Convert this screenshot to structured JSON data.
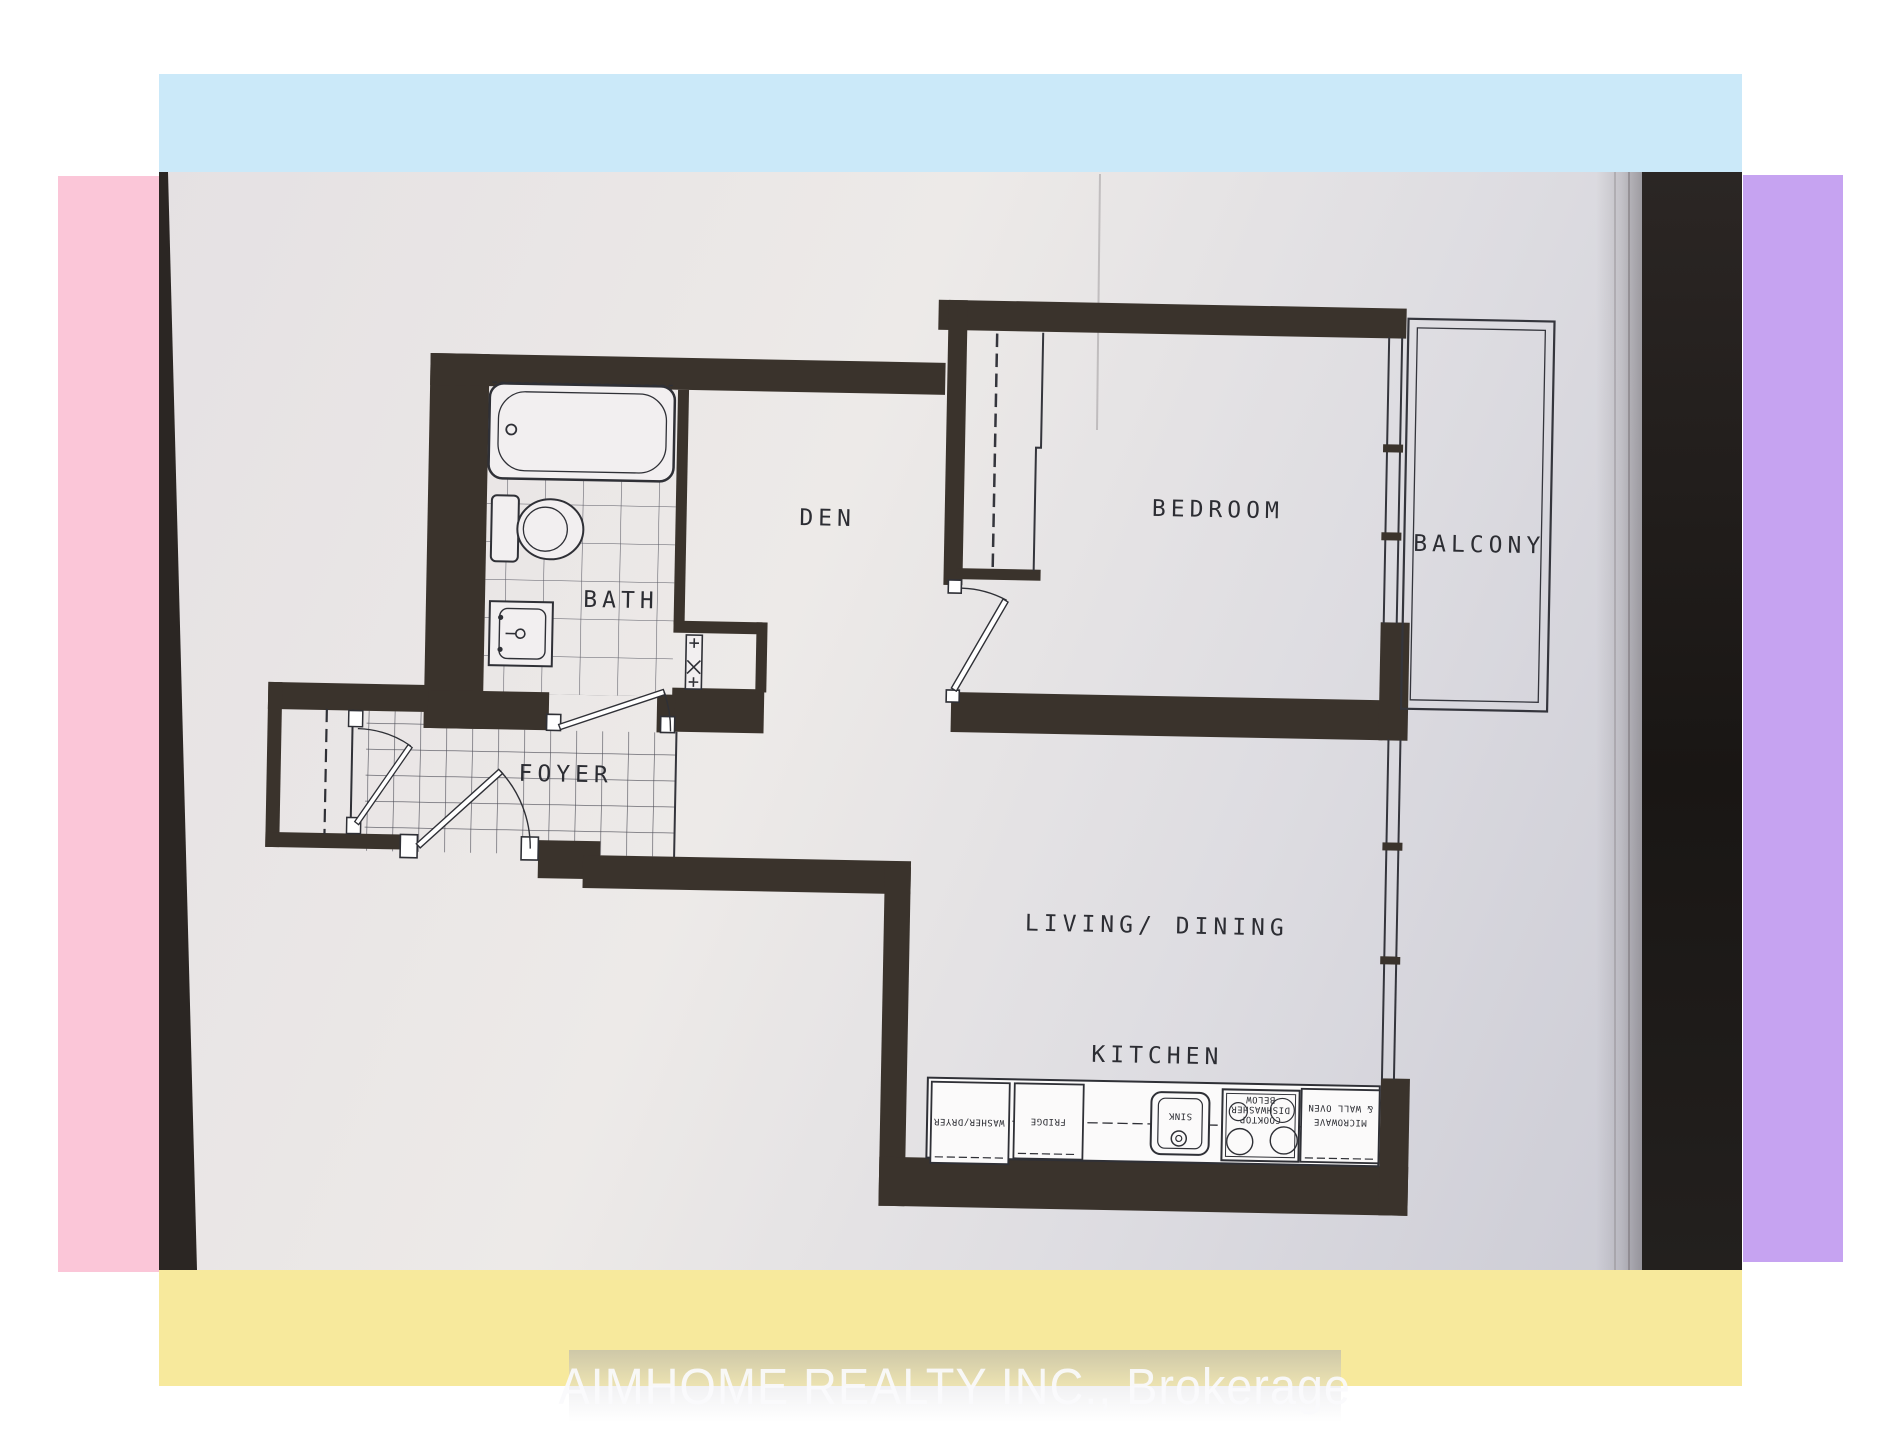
{
  "colors": {
    "canvas": "#ffffff",
    "cyan": "#cbe9f9",
    "pink": "#fbc6d8",
    "purple": "#c6a3f1",
    "yellow": "#f7e99c",
    "paper-light": "#edeae8",
    "paper-dark": "#c9c9d3",
    "table": "#211d1a",
    "wall": "#3a332c",
    "line": "#34353c",
    "label": "#2c2d33"
  },
  "rooms": {
    "den": "DEN",
    "bath": "BATH",
    "foyer": "FOYER",
    "bedroom": "BEDROOM",
    "balcony": "BALCONY",
    "living_dining": "LIVING/ DINING",
    "kitchen": "KITCHEN"
  },
  "appliances": {
    "washer_dryer": "WASHER/DRYER",
    "fridge": "FRIDGE",
    "sink": "SINK",
    "cooktop_line1": "COOKTOP",
    "cooktop_line2": "DISHWASHER",
    "cooktop_line3": "BELOW",
    "microwave_line1": "MICROWAVE",
    "microwave_line2": "& WALL OVEN"
  },
  "watermark": {
    "text": "AIMHOME REALTY INC., Brokerage"
  }
}
